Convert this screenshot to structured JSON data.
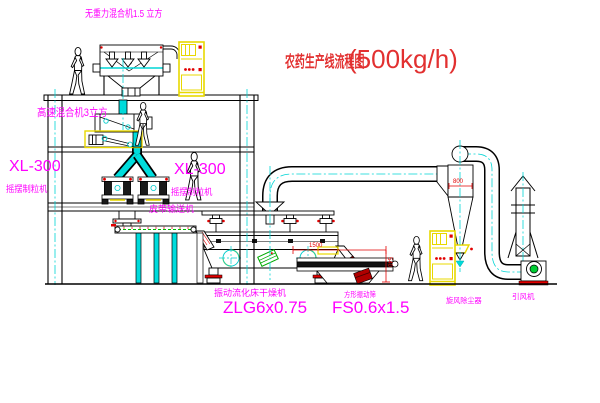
{
  "diagram": {
    "title": {
      "text": "农药生产线流程图",
      "capacity": "(500kg/h)"
    }
  },
  "labels": {
    "gravity_free_mixer": "无重力混合机1.5 立方",
    "high_speed_mixer": "高速混合机3立方",
    "granulator_left_model": "XL-300",
    "granulator_left_name": "摇摆制粒机",
    "granulator_middle_model": "XL-300",
    "granulator_middle_name": "摇摆制粒机",
    "belt_conveyor": "皮带输送机",
    "fluid_bed_dryer_name": "振动流化床干燥机",
    "fluid_bed_dryer_model": "ZLG6x0.75",
    "vibrating_screen_name": "方形振动筛",
    "vibrating_screen_model": "FS0.6x1.5",
    "cyclone_dust_collector": "旋风除尘器",
    "induced_draft_fan": "引风机"
  },
  "dimensions": {
    "cyclone_width": "800",
    "screen_length": "1500",
    "screen_height": "540"
  },
  "colors": {
    "background": "#ffffff",
    "linework": "#000000",
    "label_magenta": "#ff00ff",
    "title_red": "#e23030",
    "dimension_red": "#e20000",
    "centerline_cyan": "#00d5d5",
    "equipment_yellow": "#e8d800",
    "pipe_cyan": "#00dcdc",
    "conveyor_green": "#00bb00",
    "motor_green": "#00cc33"
  },
  "icons": {
    "person_figure": "walking-worker-silhouette",
    "target_symbol": "cad-center-target",
    "centerline": "dash-dot-centerline"
  }
}
